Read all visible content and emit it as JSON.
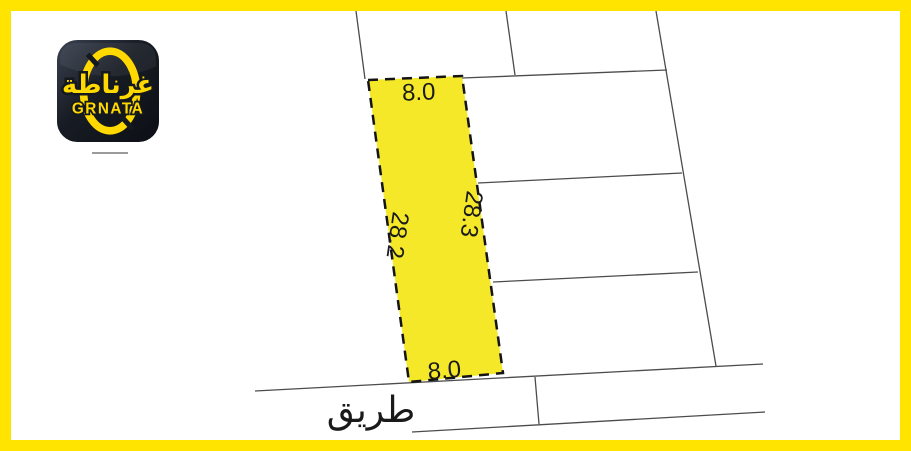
{
  "brand": {
    "arabic": "غرناطة",
    "latin": "GRNATA"
  },
  "map": {
    "road_label": "طريق",
    "plot_dimensions": {
      "top": "8.0",
      "bottom": "8.0",
      "left": "28.2",
      "right": "28.3"
    }
  },
  "colors": {
    "frame": "#ffe400",
    "plot-fill": "#f5e829",
    "line": "#4c4c4c",
    "dash": "#141414",
    "text": "#1a1a1a",
    "logo-bg": "#14181f",
    "logo-yellow": "#ffd900"
  }
}
